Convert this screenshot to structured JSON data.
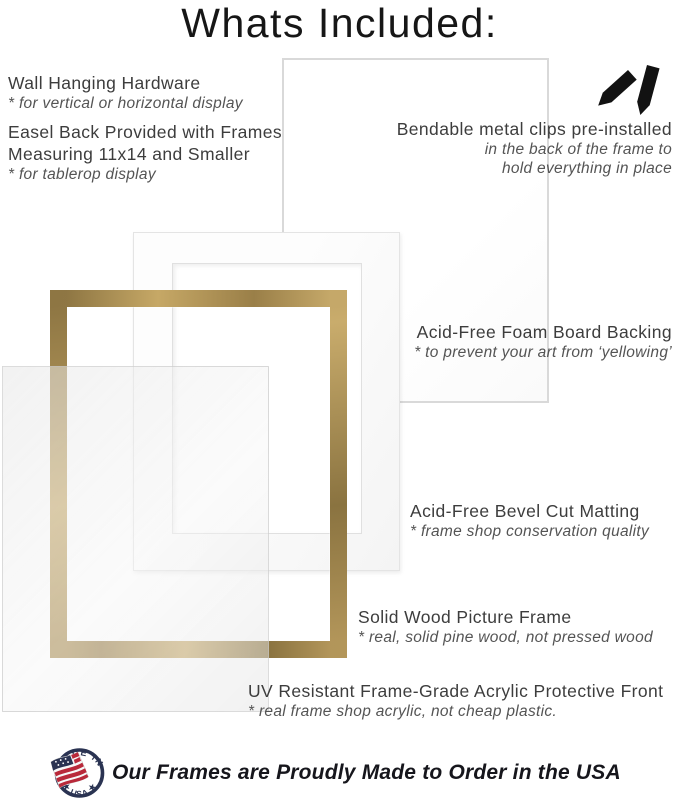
{
  "title": "Whats Included:",
  "items": {
    "wall_hanging": {
      "title": "Wall Hanging Hardware",
      "note": "* for vertical or horizontal display"
    },
    "easel_back": {
      "title_line1": "Easel Back Provided with Frames",
      "title_line2": "Measuring 11x14 and Smaller",
      "note": "* for tablerop display"
    },
    "metal_clips": {
      "title": "Bendable metal clips pre-installed",
      "note_line1": "in the back of the frame to",
      "note_line2": "hold everything in place"
    },
    "foam_board": {
      "title": "Acid-Free Foam Board Backing",
      "note": "* to prevent your art from ‘yellowing’"
    },
    "matting": {
      "title": "Acid-Free Bevel Cut Matting",
      "note": "* frame shop conservation quality"
    },
    "wood_frame": {
      "title": "Solid Wood Picture Frame",
      "note": "* real, solid pine wood, not pressed wood"
    },
    "acrylic_front": {
      "title": "UV Resistant Frame-Grade Acrylic Protective Front",
      "note": "* real frame shop acrylic, not cheap plastic."
    }
  },
  "footer": {
    "text": "Our Frames are Proudly Made to Order in the USA",
    "badge_top_text": "MADE IN",
    "badge_bottom_text": "★ USA ★"
  },
  "icons": {
    "clips": "metal-clips-icon",
    "badge": "made-in-usa-flag-badge"
  },
  "colors": {
    "frame_gold_dark": "#8a7340",
    "frame_gold_light": "#c9ab6a",
    "badge_navy": "#2a3352",
    "flag_red": "#b9293a",
    "heading_text": "#3d3d3d",
    "note_text": "#545454",
    "footer_text": "#16161c",
    "board_border": "#d9d9d9"
  }
}
